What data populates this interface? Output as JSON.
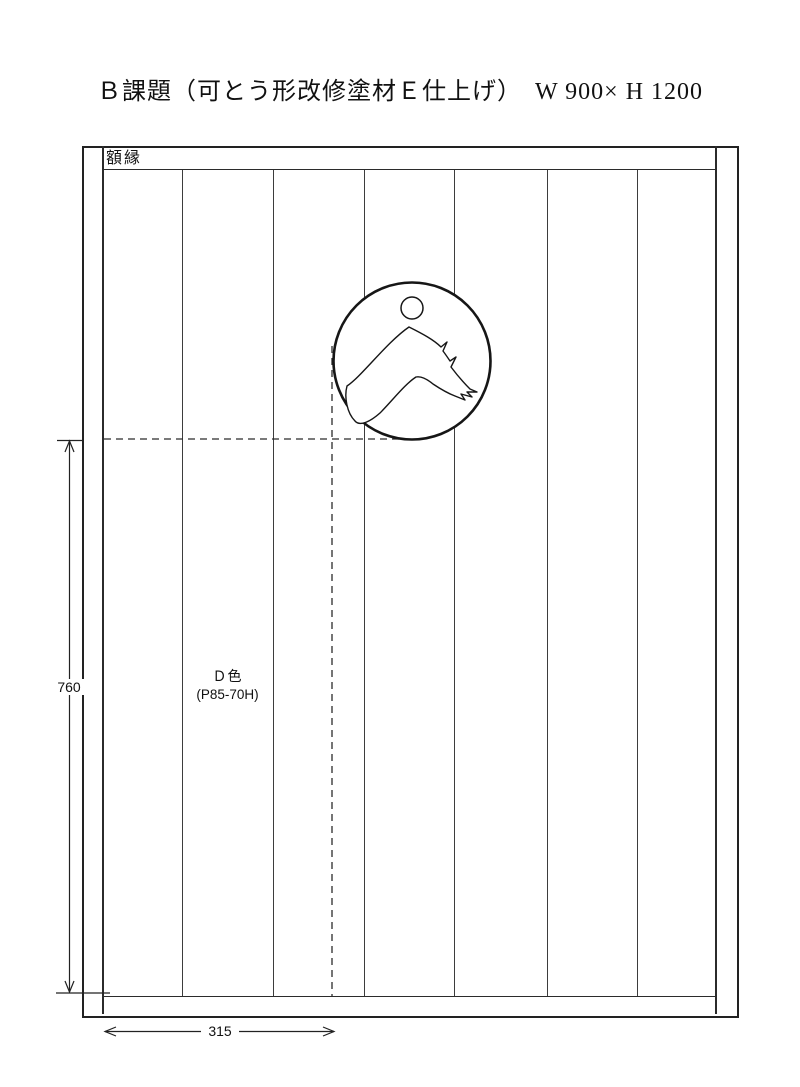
{
  "page": {
    "title": "Ｂ課題（可とう形改修塗材Ｅ仕上げ）　W 900× H 1200"
  },
  "frame": {
    "label": "額縁"
  },
  "panel_area": {
    "color_label": "Ｄ色",
    "color_code": "(P85-70H)",
    "panel_count": 7
  },
  "dimensions": {
    "height": "760",
    "width": "315"
  },
  "emblem": {
    "icon": "person-wave-emblem"
  },
  "colors": {
    "line": "#2b2b2b",
    "background": "#ffffff"
  }
}
